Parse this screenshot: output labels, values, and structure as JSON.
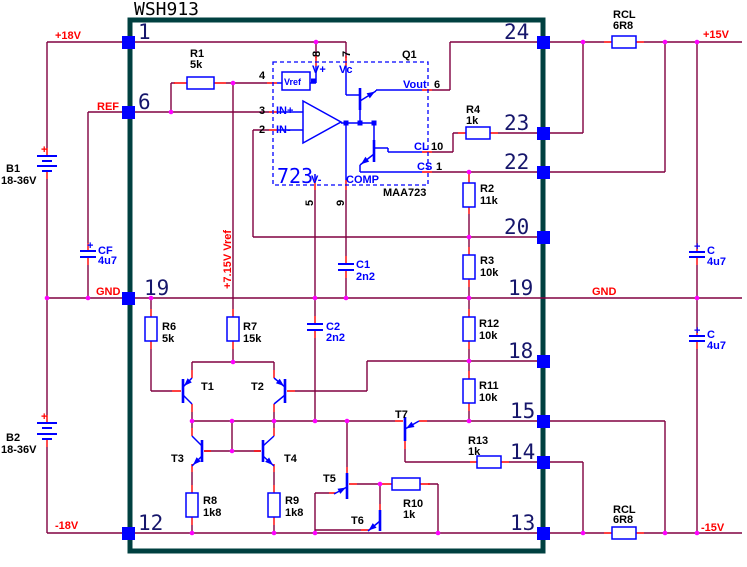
{
  "window": {
    "title": "WSH913"
  },
  "colors": {
    "wire": "#800040",
    "lead": "#ff0000",
    "component_outline": "#0000ff",
    "hybrid_border": "#004040",
    "junction": "#ff00ff",
    "pin_number": "#16166b",
    "net_label": "#ff0000",
    "component_label": "#000000"
  },
  "pins": {
    "p1": "1",
    "p6": "6",
    "p19_left": "19",
    "p12": "12",
    "p24": "24",
    "p23": "23",
    "p22": "22",
    "p20": "20",
    "p19_right": "19",
    "p18": "18",
    "p15": "15",
    "p14": "14",
    "p13": "13"
  },
  "nets": {
    "plus18": "+18V",
    "ref": "REF",
    "gnd_left": "GND",
    "minus18": "-18V",
    "plus15": "+15V",
    "gnd_right": "GND",
    "minus15": "-15V",
    "vref_rail": "+7.15V Vref"
  },
  "regulator": {
    "designator": "Q1",
    "part": "MAA723",
    "die_label": "723",
    "vref_block": "Vref",
    "pins": {
      "vplus": {
        "name": "V+",
        "num": "8"
      },
      "vc": {
        "name": "Vc",
        "num": "7"
      },
      "vref_in": {
        "num": "4"
      },
      "in_plus": {
        "name": "IN+",
        "num": "3"
      },
      "in_minus": {
        "name": "IN-",
        "num": "2"
      },
      "vout": {
        "name": "Vout",
        "num": "6"
      },
      "cl": {
        "name": "CL",
        "num": "10"
      },
      "cs": {
        "name": "CS",
        "num": "1"
      },
      "vminus": {
        "name": "V-",
        "num": "5"
      },
      "comp": {
        "name": "COMP",
        "num": "9"
      }
    }
  },
  "resistors": {
    "r1": {
      "ref": "R1",
      "value": "5k"
    },
    "r2": {
      "ref": "R2",
      "value": "11k"
    },
    "r3": {
      "ref": "R3",
      "value": "10k"
    },
    "r4": {
      "ref": "R4",
      "value": "1k"
    },
    "r6": {
      "ref": "R6",
      "value": "5k"
    },
    "r7": {
      "ref": "R7",
      "value": "15k"
    },
    "r8": {
      "ref": "R8",
      "value": "1k8"
    },
    "r9": {
      "ref": "R9",
      "value": "1k8"
    },
    "r10": {
      "ref": "R10",
      "value": "1k"
    },
    "r11": {
      "ref": "R11",
      "value": "10k"
    },
    "r12": {
      "ref": "R12",
      "value": "10k"
    },
    "r13": {
      "ref": "R13",
      "value": "1k"
    },
    "rcl_top": {
      "ref": "RCL",
      "value": "6R8"
    },
    "rcl_bottom": {
      "ref": "RCL",
      "value": "6R8"
    }
  },
  "capacitors": {
    "c1": {
      "ref": "C1",
      "value": "2n2"
    },
    "c2": {
      "ref": "C2",
      "value": "2n2"
    },
    "cf": {
      "ref": "CF",
      "value": "4u7",
      "polarity": "+"
    },
    "c_top": {
      "ref": "C",
      "value": "4u7",
      "polarity": "+"
    },
    "c_bottom": {
      "ref": "C",
      "value": "4u7",
      "polarity": "+"
    }
  },
  "batteries": {
    "b1": {
      "ref": "B1",
      "value": "18-36V",
      "polarity": "+"
    },
    "b2": {
      "ref": "B2",
      "value": "18-36V",
      "polarity": "+"
    }
  },
  "transistors": {
    "t1": "T1",
    "t2": "T2",
    "t3": "T3",
    "t4": "T4",
    "t5": "T5",
    "t6": "T6",
    "t7": "T7"
  }
}
